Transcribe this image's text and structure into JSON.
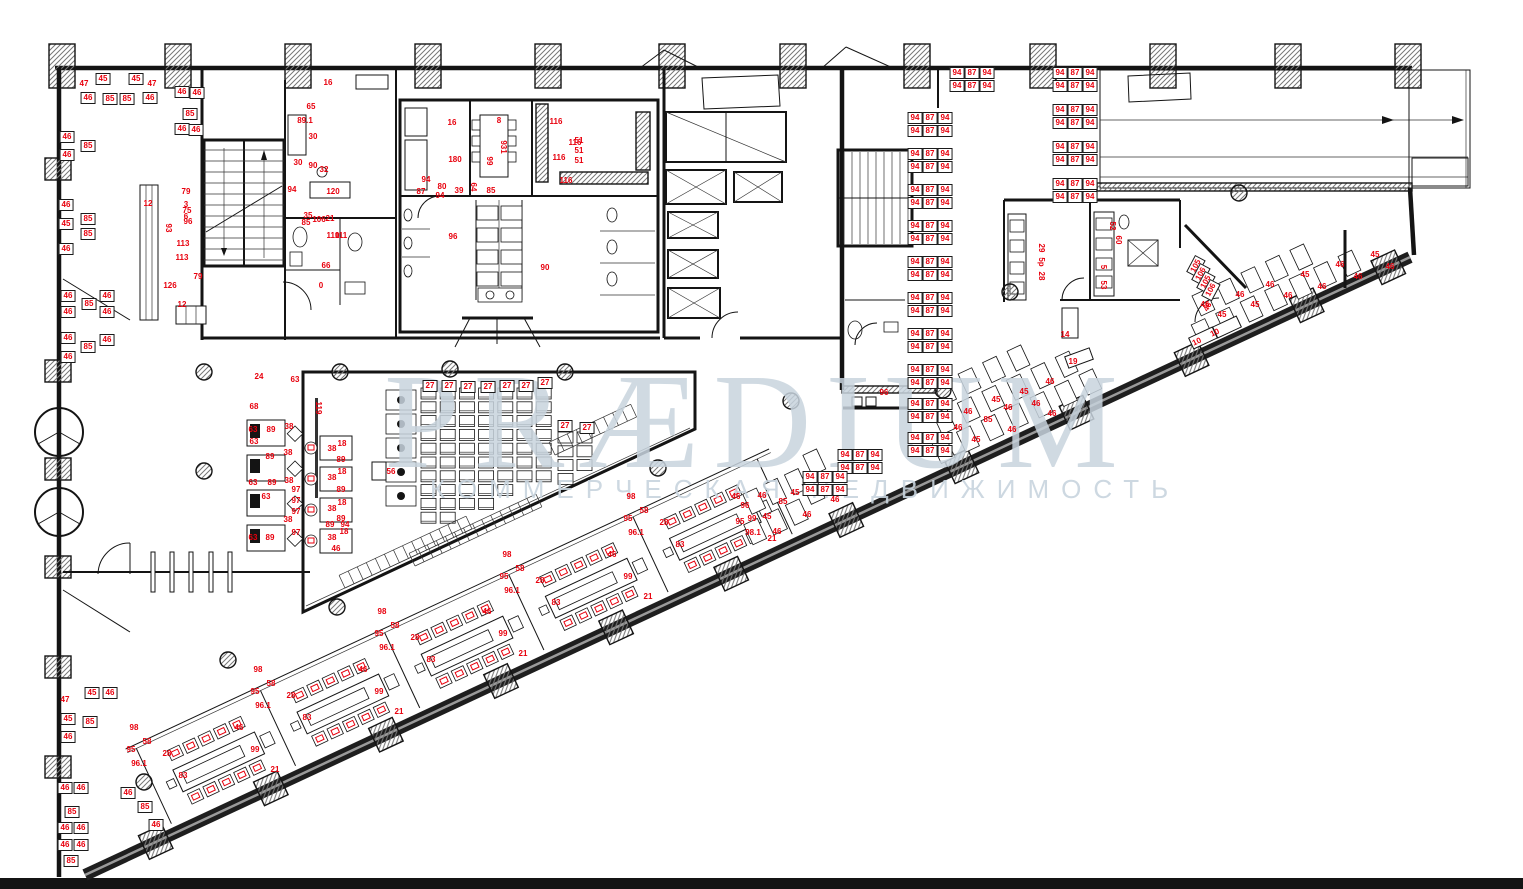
{
  "watermark": {
    "line1": "PRÆDIUM",
    "line2": "КОММЕРЧЕСКАЯ НЕДВИЖИМОСТЬ"
  },
  "colors": {
    "label_red": "#e8000d",
    "watermark_blue": "#c8d4de",
    "wall_black": "#141414"
  },
  "desk_clusters": {
    "rows": [
      "94 87 94",
      "94 87 94"
    ],
    "row_height": 13,
    "col_width": 15,
    "positions": [
      [
        957,
        73
      ],
      [
        1060,
        73
      ],
      [
        1060,
        110
      ],
      [
        1060,
        147
      ],
      [
        1060,
        184
      ],
      [
        915,
        118
      ],
      [
        915,
        154
      ],
      [
        915,
        190
      ],
      [
        915,
        226
      ],
      [
        915,
        262
      ],
      [
        915,
        298
      ],
      [
        915,
        334
      ],
      [
        915,
        370
      ],
      [
        915,
        404
      ],
      [
        915,
        438
      ],
      [
        845,
        455
      ],
      [
        810,
        477
      ]
    ]
  },
  "labels": [
    {
      "t": "47",
      "x": 84,
      "y": 84
    },
    {
      "t": "45",
      "x": 103,
      "y": 79,
      "b": 1
    },
    {
      "t": "45",
      "x": 136,
      "y": 79,
      "b": 1
    },
    {
      "t": "47",
      "x": 152,
      "y": 84
    },
    {
      "t": "46",
      "x": 88,
      "y": 98,
      "b": 1
    },
    {
      "t": "85",
      "x": 110,
      "y": 99,
      "b": 1
    },
    {
      "t": "85",
      "x": 127,
      "y": 99,
      "b": 1
    },
    {
      "t": "46",
      "x": 150,
      "y": 98,
      "b": 1
    },
    {
      "t": "46",
      "x": 182,
      "y": 92,
      "b": 1
    },
    {
      "t": "46",
      "x": 197,
      "y": 93,
      "b": 1
    },
    {
      "t": "85",
      "x": 190,
      "y": 114,
      "b": 1
    },
    {
      "t": "46",
      "x": 182,
      "y": 129,
      "b": 1
    },
    {
      "t": "46",
      "x": 196,
      "y": 130,
      "b": 1
    },
    {
      "t": "46",
      "x": 67,
      "y": 137,
      "b": 1
    },
    {
      "t": "85",
      "x": 88,
      "y": 146,
      "b": 1
    },
    {
      "t": "46",
      "x": 67,
      "y": 155,
      "b": 1
    },
    {
      "t": "46",
      "x": 66,
      "y": 205,
      "b": 1
    },
    {
      "t": "85",
      "x": 88,
      "y": 219,
      "b": 1
    },
    {
      "t": "45",
      "x": 66,
      "y": 224,
      "b": 1
    },
    {
      "t": "85",
      "x": 88,
      "y": 234,
      "b": 1
    },
    {
      "t": "46",
      "x": 66,
      "y": 249,
      "b": 1
    },
    {
      "t": "46",
      "x": 68,
      "y": 296,
      "b": 1
    },
    {
      "t": "85",
      "x": 89,
      "y": 304,
      "b": 1
    },
    {
      "t": "46",
      "x": 107,
      "y": 296,
      "b": 1
    },
    {
      "t": "46",
      "x": 68,
      "y": 312,
      "b": 1
    },
    {
      "t": "46",
      "x": 107,
      "y": 312,
      "b": 1
    },
    {
      "t": "46",
      "x": 68,
      "y": 338,
      "b": 1
    },
    {
      "t": "85",
      "x": 88,
      "y": 347,
      "b": 1
    },
    {
      "t": "46",
      "x": 107,
      "y": 340,
      "b": 1
    },
    {
      "t": "46",
      "x": 68,
      "y": 357,
      "b": 1
    },
    {
      "t": "45",
      "x": 92,
      "y": 693,
      "b": 1
    },
    {
      "t": "46",
      "x": 110,
      "y": 693,
      "b": 1
    },
    {
      "t": "47",
      "x": 65,
      "y": 700
    },
    {
      "t": "45",
      "x": 68,
      "y": 719,
      "b": 1
    },
    {
      "t": "85",
      "x": 90,
      "y": 722,
      "b": 1
    },
    {
      "t": "46",
      "x": 68,
      "y": 737,
      "b": 1
    },
    {
      "t": "46",
      "x": 65,
      "y": 788,
      "b": 1
    },
    {
      "t": "46",
      "x": 81,
      "y": 788,
      "b": 1
    },
    {
      "t": "85",
      "x": 72,
      "y": 812,
      "b": 1
    },
    {
      "t": "46",
      "x": 65,
      "y": 828,
      "b": 1
    },
    {
      "t": "46",
      "x": 81,
      "y": 828,
      "b": 1
    },
    {
      "t": "46",
      "x": 65,
      "y": 845,
      "b": 1
    },
    {
      "t": "46",
      "x": 81,
      "y": 845,
      "b": 1
    },
    {
      "t": "85",
      "x": 71,
      "y": 861,
      "b": 1
    },
    {
      "t": "46",
      "x": 128,
      "y": 793,
      "b": 1
    },
    {
      "t": "85",
      "x": 145,
      "y": 807,
      "b": 1
    },
    {
      "t": "46",
      "x": 156,
      "y": 825,
      "b": 1
    },
    {
      "t": "12",
      "x": 148,
      "y": 204
    },
    {
      "t": "93",
      "x": 168,
      "y": 228,
      "r": 90
    },
    {
      "t": "79",
      "x": 186,
      "y": 192
    },
    {
      "t": "3",
      "x": 186,
      "y": 205
    },
    {
      "t": "75",
      "x": 187,
      "y": 211
    },
    {
      "t": "6",
      "x": 186,
      "y": 217
    },
    {
      "t": "96",
      "x": 188,
      "y": 222
    },
    {
      "t": "113",
      "x": 183,
      "y": 244
    },
    {
      "t": "113",
      "x": 182,
      "y": 258
    },
    {
      "t": "79",
      "x": 198,
      "y": 277
    },
    {
      "t": "126",
      "x": 170,
      "y": 286
    },
    {
      "t": "12",
      "x": 182,
      "y": 305
    },
    {
      "t": "16",
      "x": 328,
      "y": 83
    },
    {
      "t": "65",
      "x": 311,
      "y": 107
    },
    {
      "t": "89.1",
      "x": 305,
      "y": 121
    },
    {
      "t": "30",
      "x": 313,
      "y": 137
    },
    {
      "t": "30",
      "x": 298,
      "y": 163
    },
    {
      "t": "90",
      "x": 313,
      "y": 166
    },
    {
      "t": "32",
      "x": 324,
      "y": 170
    },
    {
      "t": "94",
      "x": 292,
      "y": 190
    },
    {
      "t": "120",
      "x": 333,
      "y": 192
    },
    {
      "t": "35",
      "x": 308,
      "y": 216
    },
    {
      "t": "85",
      "x": 306,
      "y": 223
    },
    {
      "t": "106",
      "x": 319,
      "y": 220
    },
    {
      "t": "21",
      "x": 330,
      "y": 219
    },
    {
      "t": "110",
      "x": 333,
      "y": 236
    },
    {
      "t": "111",
      "x": 341,
      "y": 236
    },
    {
      "t": "66",
      "x": 326,
      "y": 266
    },
    {
      "t": "0",
      "x": 321,
      "y": 286
    },
    {
      "t": "16",
      "x": 452,
      "y": 123
    },
    {
      "t": "8",
      "x": 499,
      "y": 121
    },
    {
      "t": "931",
      "x": 503,
      "y": 147,
      "r": 90
    },
    {
      "t": "99",
      "x": 489,
      "y": 161,
      "r": 90
    },
    {
      "t": "180",
      "x": 455,
      "y": 160
    },
    {
      "t": "51",
      "x": 579,
      "y": 141
    },
    {
      "t": "51",
      "x": 579,
      "y": 151
    },
    {
      "t": "51",
      "x": 579,
      "y": 161
    },
    {
      "t": "116",
      "x": 556,
      "y": 122
    },
    {
      "t": "116",
      "x": 575,
      "y": 143
    },
    {
      "t": "116",
      "x": 559,
      "y": 158
    },
    {
      "t": "116",
      "x": 566,
      "y": 181
    },
    {
      "t": "94",
      "x": 426,
      "y": 180
    },
    {
      "t": "80",
      "x": 442,
      "y": 187
    },
    {
      "t": "87",
      "x": 421,
      "y": 192
    },
    {
      "t": "94",
      "x": 440,
      "y": 196
    },
    {
      "t": "39",
      "x": 459,
      "y": 191
    },
    {
      "t": "64",
      "x": 473,
      "y": 187,
      "r": 90
    },
    {
      "t": "85",
      "x": 491,
      "y": 191
    },
    {
      "t": "96",
      "x": 453,
      "y": 237
    },
    {
      "t": "90",
      "x": 545,
      "y": 268
    },
    {
      "t": "29",
      "x": 1041,
      "y": 248,
      "r": 90
    },
    {
      "t": "5p",
      "x": 1041,
      "y": 262,
      "r": 90
    },
    {
      "t": "28",
      "x": 1041,
      "y": 276,
      "r": 90
    },
    {
      "t": "52",
      "x": 1112,
      "y": 226,
      "r": 90
    },
    {
      "t": "60",
      "x": 1118,
      "y": 240,
      "r": 90
    },
    {
      "t": "5",
      "x": 1103,
      "y": 267,
      "r": 90
    },
    {
      "t": "53",
      "x": 1103,
      "y": 285,
      "r": 90
    },
    {
      "t": "14",
      "x": 1065,
      "y": 335
    },
    {
      "t": "19",
      "x": 1073,
      "y": 362
    },
    {
      "t": "10",
      "x": 1197,
      "y": 342,
      "r": -25
    },
    {
      "t": "10",
      "x": 1215,
      "y": 333,
      "r": -25
    },
    {
      "t": "46",
      "x": 1208,
      "y": 307,
      "r": -62
    },
    {
      "t": "105",
      "x": 1196,
      "y": 266,
      "b": 1,
      "r": -62
    },
    {
      "t": "106",
      "x": 1201,
      "y": 274,
      "b": 1,
      "r": -62
    },
    {
      "t": "105",
      "x": 1206,
      "y": 282,
      "b": 1,
      "r": -62
    },
    {
      "t": "106",
      "x": 1211,
      "y": 290,
      "b": 1,
      "r": -62
    },
    {
      "t": "96",
      "x": 884,
      "y": 393
    },
    {
      "t": "27",
      "x": 430,
      "y": 386,
      "b": 1
    },
    {
      "t": "27",
      "x": 449,
      "y": 386,
      "b": 1
    },
    {
      "t": "27",
      "x": 468,
      "y": 387,
      "b": 1
    },
    {
      "t": "27",
      "x": 488,
      "y": 387,
      "b": 1
    },
    {
      "t": "27",
      "x": 507,
      "y": 386,
      "b": 1
    },
    {
      "t": "27",
      "x": 526,
      "y": 386,
      "b": 1
    },
    {
      "t": "27",
      "x": 545,
      "y": 383,
      "b": 1
    },
    {
      "t": "27",
      "x": 565,
      "y": 426,
      "b": 1
    },
    {
      "t": "27",
      "x": 587,
      "y": 428,
      "b": 1
    },
    {
      "t": "24",
      "x": 259,
      "y": 377
    },
    {
      "t": "63",
      "x": 295,
      "y": 380
    },
    {
      "t": "68",
      "x": 254,
      "y": 407
    },
    {
      "t": "63",
      "x": 253,
      "y": 430
    },
    {
      "t": "89",
      "x": 271,
      "y": 430
    },
    {
      "t": "38",
      "x": 289,
      "y": 427
    },
    {
      "t": "63",
      "x": 254,
      "y": 442
    },
    {
      "t": "89",
      "x": 270,
      "y": 457
    },
    {
      "t": "38",
      "x": 288,
      "y": 453
    },
    {
      "t": "63",
      "x": 253,
      "y": 483
    },
    {
      "t": "89",
      "x": 272,
      "y": 483
    },
    {
      "t": "38",
      "x": 289,
      "y": 481
    },
    {
      "t": "97",
      "x": 296,
      "y": 490
    },
    {
      "t": "63",
      "x": 266,
      "y": 497
    },
    {
      "t": "97",
      "x": 296,
      "y": 501
    },
    {
      "t": "97",
      "x": 296,
      "y": 512
    },
    {
      "t": "38",
      "x": 288,
      "y": 520
    },
    {
      "t": "97",
      "x": 296,
      "y": 533
    },
    {
      "t": "63",
      "x": 253,
      "y": 538
    },
    {
      "t": "89",
      "x": 270,
      "y": 538
    },
    {
      "t": "119",
      "x": 318,
      "y": 408,
      "r": 90
    },
    {
      "t": "18",
      "x": 342,
      "y": 444
    },
    {
      "t": "38",
      "x": 332,
      "y": 449
    },
    {
      "t": "89",
      "x": 341,
      "y": 460
    },
    {
      "t": "18",
      "x": 342,
      "y": 472
    },
    {
      "t": "38",
      "x": 332,
      "y": 478
    },
    {
      "t": "89",
      "x": 341,
      "y": 490
    },
    {
      "t": "18",
      "x": 342,
      "y": 503
    },
    {
      "t": "38",
      "x": 332,
      "y": 509
    },
    {
      "t": "89",
      "x": 341,
      "y": 519
    },
    {
      "t": "89",
      "x": 330,
      "y": 525
    },
    {
      "t": "94",
      "x": 345,
      "y": 525
    },
    {
      "t": "18",
      "x": 344,
      "y": 532
    },
    {
      "t": "38",
      "x": 332,
      "y": 538
    },
    {
      "t": "46",
      "x": 336,
      "y": 549
    },
    {
      "t": "56",
      "x": 391,
      "y": 472
    },
    {
      "t": "28",
      "x": 167,
      "y": 754
    },
    {
      "t": "83",
      "x": 183,
      "y": 776
    },
    {
      "t": "99",
      "x": 255,
      "y": 750
    },
    {
      "t": "21",
      "x": 275,
      "y": 770
    },
    {
      "t": "46",
      "x": 239,
      "y": 728
    },
    {
      "t": "58",
      "x": 147,
      "y": 742
    },
    {
      "t": "98",
      "x": 134,
      "y": 728
    },
    {
      "t": "95",
      "x": 131,
      "y": 750
    },
    {
      "t": "96.1",
      "x": 139,
      "y": 764
    },
    {
      "t": "28",
      "x": 291,
      "y": 696
    },
    {
      "t": "83",
      "x": 307,
      "y": 718
    },
    {
      "t": "99",
      "x": 379,
      "y": 692
    },
    {
      "t": "21",
      "x": 399,
      "y": 712
    },
    {
      "t": "46",
      "x": 363,
      "y": 670
    },
    {
      "t": "58",
      "x": 271,
      "y": 684
    },
    {
      "t": "98",
      "x": 258,
      "y": 670
    },
    {
      "t": "95",
      "x": 255,
      "y": 692
    },
    {
      "t": "96.1",
      "x": 263,
      "y": 706
    },
    {
      "t": "28",
      "x": 415,
      "y": 638
    },
    {
      "t": "83",
      "x": 431,
      "y": 660
    },
    {
      "t": "99",
      "x": 503,
      "y": 634
    },
    {
      "t": "21",
      "x": 523,
      "y": 654
    },
    {
      "t": "46",
      "x": 487,
      "y": 612
    },
    {
      "t": "58",
      "x": 395,
      "y": 626
    },
    {
      "t": "98",
      "x": 382,
      "y": 612
    },
    {
      "t": "95",
      "x": 379,
      "y": 634
    },
    {
      "t": "96.1",
      "x": 387,
      "y": 648
    },
    {
      "t": "28",
      "x": 540,
      "y": 581
    },
    {
      "t": "83",
      "x": 556,
      "y": 603
    },
    {
      "t": "99",
      "x": 628,
      "y": 577
    },
    {
      "t": "21",
      "x": 648,
      "y": 597
    },
    {
      "t": "46",
      "x": 612,
      "y": 555
    },
    {
      "t": "58",
      "x": 520,
      "y": 569
    },
    {
      "t": "98",
      "x": 507,
      "y": 555
    },
    {
      "t": "95",
      "x": 504,
      "y": 577
    },
    {
      "t": "96.1",
      "x": 512,
      "y": 591
    },
    {
      "t": "28",
      "x": 664,
      "y": 523
    },
    {
      "t": "83",
      "x": 680,
      "y": 545
    },
    {
      "t": "99",
      "x": 752,
      "y": 519
    },
    {
      "t": "21",
      "x": 772,
      "y": 539
    },
    {
      "t": "46",
      "x": 736,
      "y": 497
    },
    {
      "t": "58",
      "x": 644,
      "y": 511
    },
    {
      "t": "98",
      "x": 631,
      "y": 497
    },
    {
      "t": "95",
      "x": 628,
      "y": 519
    },
    {
      "t": "96.1",
      "x": 636,
      "y": 533
    },
    {
      "t": "46",
      "x": 762,
      "y": 496
    },
    {
      "t": "85",
      "x": 783,
      "y": 502
    },
    {
      "t": "45",
      "x": 795,
      "y": 493
    },
    {
      "t": "45",
      "x": 767,
      "y": 517
    },
    {
      "t": "46",
      "x": 777,
      "y": 532
    },
    {
      "t": "46",
      "x": 807,
      "y": 515
    },
    {
      "t": "96",
      "x": 745,
      "y": 506
    },
    {
      "t": "95",
      "x": 740,
      "y": 522
    },
    {
      "t": "98.1",
      "x": 753,
      "y": 533
    },
    {
      "t": "45",
      "x": 820,
      "y": 478
    },
    {
      "t": "46",
      "x": 835,
      "y": 500
    },
    {
      "t": "46",
      "x": 940,
      "y": 440
    },
    {
      "t": "46",
      "x": 958,
      "y": 428
    },
    {
      "t": "45",
      "x": 976,
      "y": 440
    },
    {
      "t": "46",
      "x": 968,
      "y": 412
    },
    {
      "t": "85",
      "x": 988,
      "y": 420
    },
    {
      "t": "45",
      "x": 996,
      "y": 400
    },
    {
      "t": "46",
      "x": 1008,
      "y": 408
    },
    {
      "t": "46",
      "x": 1012,
      "y": 430
    },
    {
      "t": "45",
      "x": 1024,
      "y": 392
    },
    {
      "t": "46",
      "x": 1036,
      "y": 404
    },
    {
      "t": "46",
      "x": 1050,
      "y": 382
    },
    {
      "t": "46",
      "x": 1052,
      "y": 414
    },
    {
      "t": "46",
      "x": 1205,
      "y": 305
    },
    {
      "t": "45",
      "x": 1222,
      "y": 315
    },
    {
      "t": "46",
      "x": 1240,
      "y": 295
    },
    {
      "t": "45",
      "x": 1255,
      "y": 305
    },
    {
      "t": "46",
      "x": 1270,
      "y": 285
    },
    {
      "t": "46",
      "x": 1288,
      "y": 296
    },
    {
      "t": "45",
      "x": 1305,
      "y": 275
    },
    {
      "t": "46",
      "x": 1322,
      "y": 287
    },
    {
      "t": "46",
      "x": 1340,
      "y": 265
    },
    {
      "t": "46",
      "x": 1358,
      "y": 277
    },
    {
      "t": "45",
      "x": 1375,
      "y": 255
    },
    {
      "t": "46",
      "x": 1390,
      "y": 267
    }
  ]
}
